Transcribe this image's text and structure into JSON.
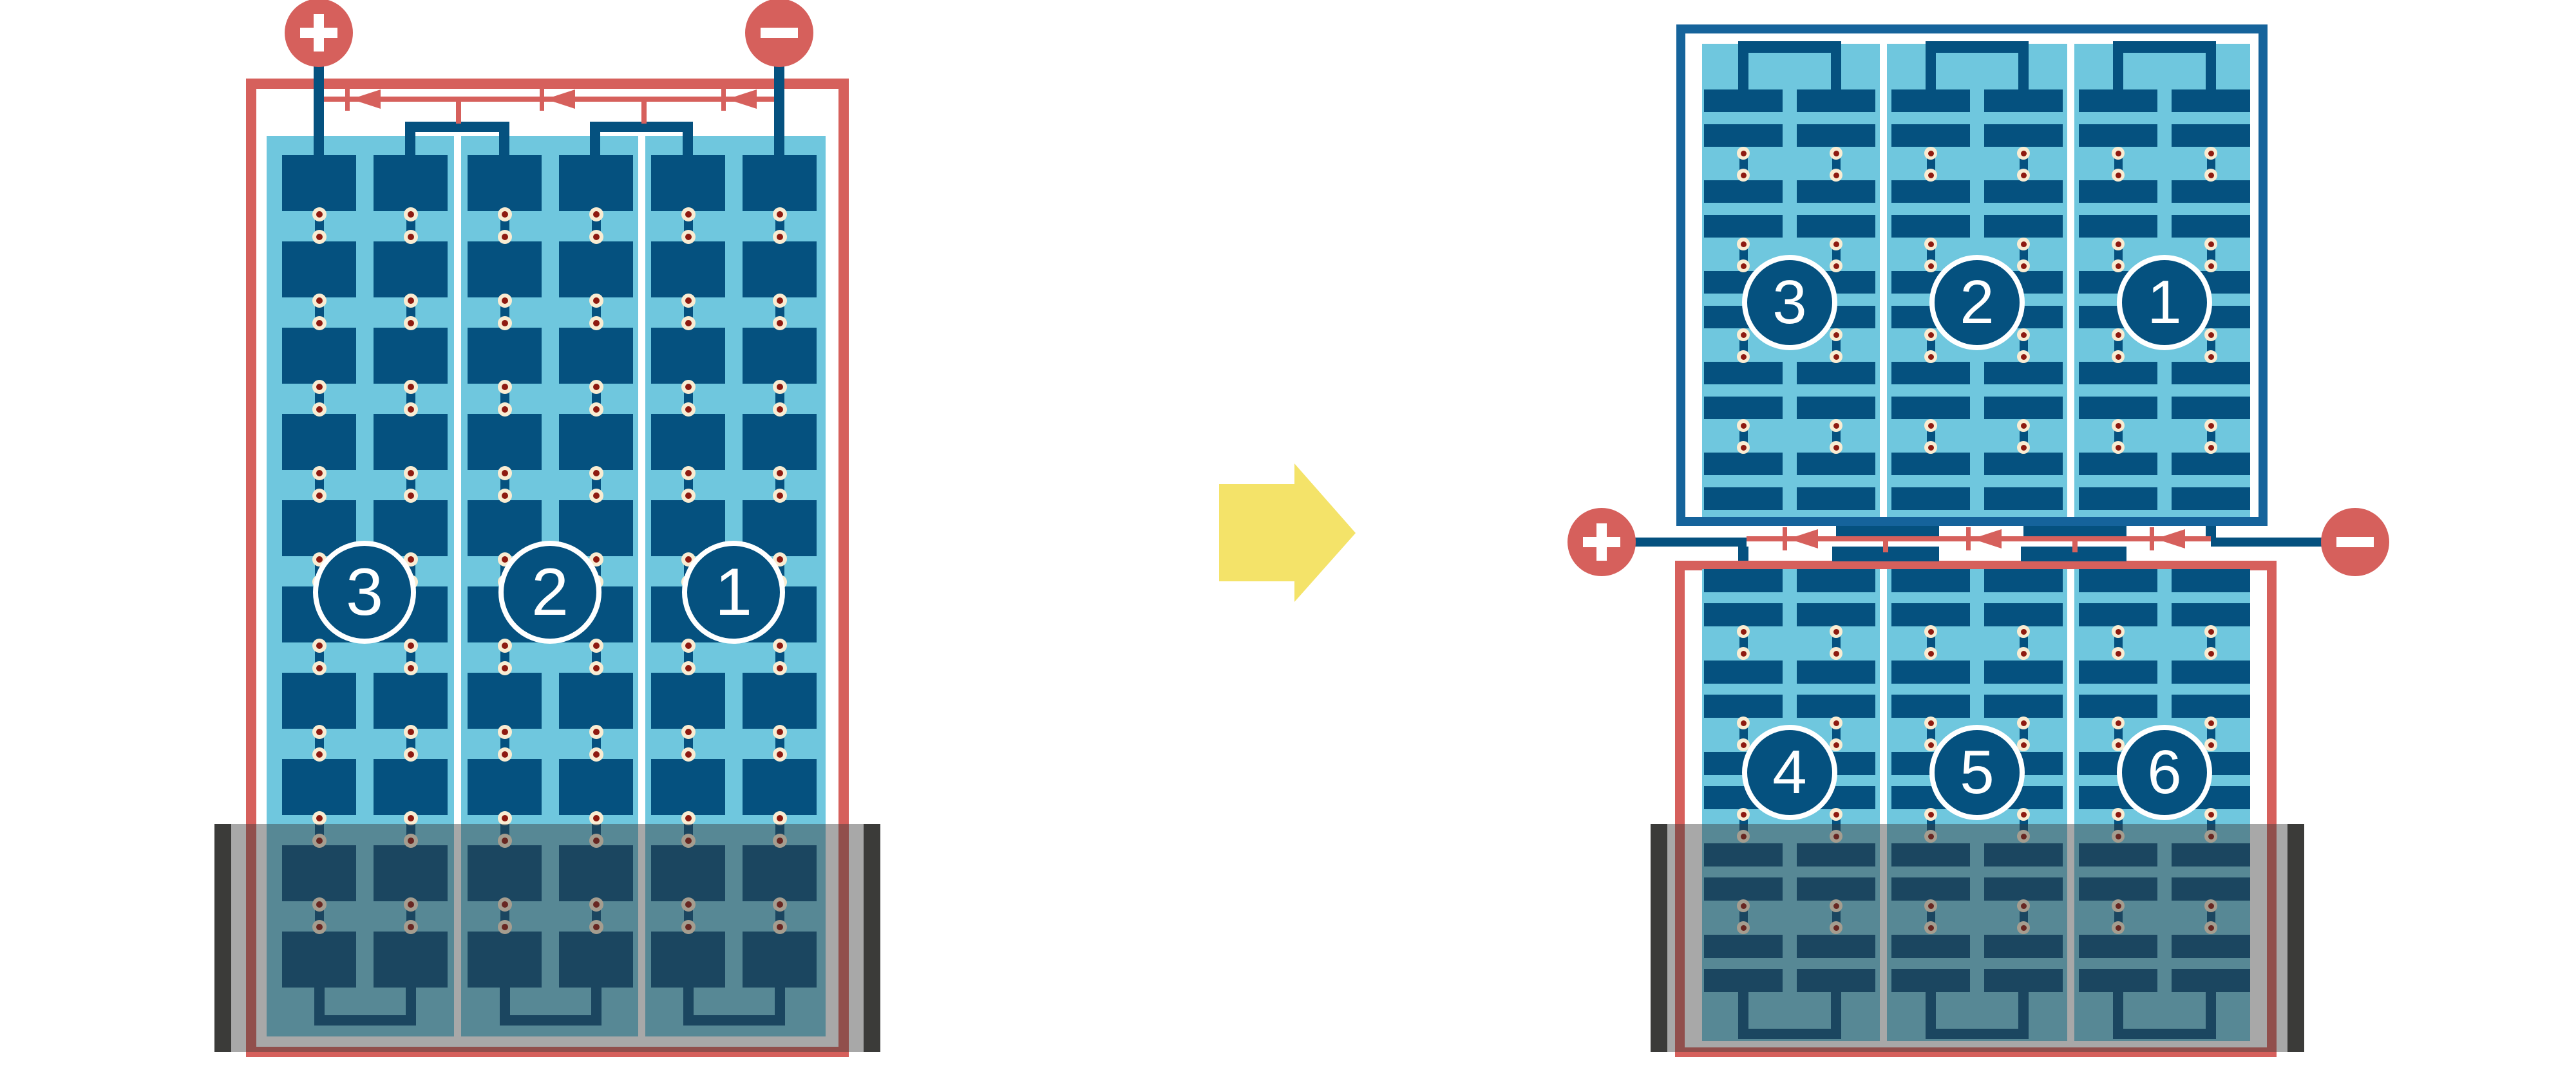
{
  "diagram": {
    "left_module": {
      "string_labels": [
        "3",
        "2",
        "1"
      ],
      "terminal_positive_label": "+",
      "terminal_negative_label": "-"
    },
    "right_top_module": {
      "string_labels": [
        "3",
        "2",
        "1"
      ]
    },
    "right_bottom_module": {
      "string_labels": [
        "4",
        "5",
        "6"
      ],
      "terminal_positive_label": "+",
      "terminal_negative_label": "-"
    },
    "icons": {
      "positive_terminal": "plus-terminal-icon",
      "negative_terminal": "minus-terminal-icon",
      "bypass_diode": "diode-icon",
      "transform_arrow": "right-arrow-icon"
    },
    "colors": {
      "red": "#D6605C",
      "dark_blue": "#05517F",
      "light_blue": "#6FC7DE",
      "frame_blue": "#15639B",
      "solder_cream": "#F9ECD2",
      "solder_dot_red": "#8E1A10",
      "charcoal": "#3B3B39",
      "flood_overlay": "rgba(58,58,58,0.44)",
      "arrow_yellow": "#F4E369"
    }
  }
}
